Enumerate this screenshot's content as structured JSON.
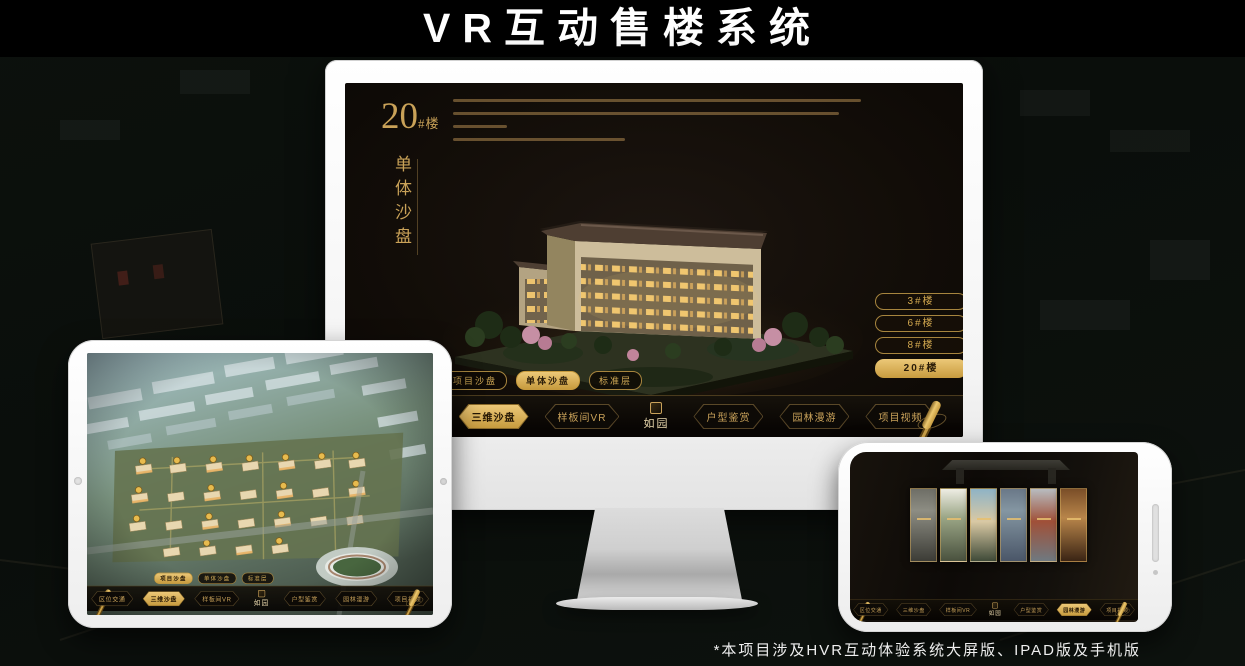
{
  "title": "VR互动售楼系统",
  "footnote": "*本项目涉及HVR互动体验系统大屏版、IPAD版及手机版",
  "colors": {
    "gold": "#d2a84f",
    "gold_bright": "#ecc878",
    "screen_bg": "#120d08",
    "bezel": "#f4f4f4"
  },
  "tabs": [
    {
      "label": "项目沙盘"
    },
    {
      "label": "单体沙盘"
    },
    {
      "label": "标准层"
    }
  ],
  "nav": {
    "logo": "如园",
    "items": [
      {
        "label": "区位交通"
      },
      {
        "label": "三维沙盘"
      },
      {
        "label": "样板间VR"
      },
      {
        "label": "户型鉴赏"
      },
      {
        "label": "园林漫游"
      },
      {
        "label": "项目视频"
      }
    ]
  },
  "monitor": {
    "hero": {
      "number": "20",
      "suffix": "#楼",
      "subtitle": "单体沙盘"
    },
    "floor_buttons": [
      {
        "label": "3#楼"
      },
      {
        "label": "6#楼"
      },
      {
        "label": "8#楼"
      },
      {
        "label": "20#楼"
      }
    ]
  }
}
